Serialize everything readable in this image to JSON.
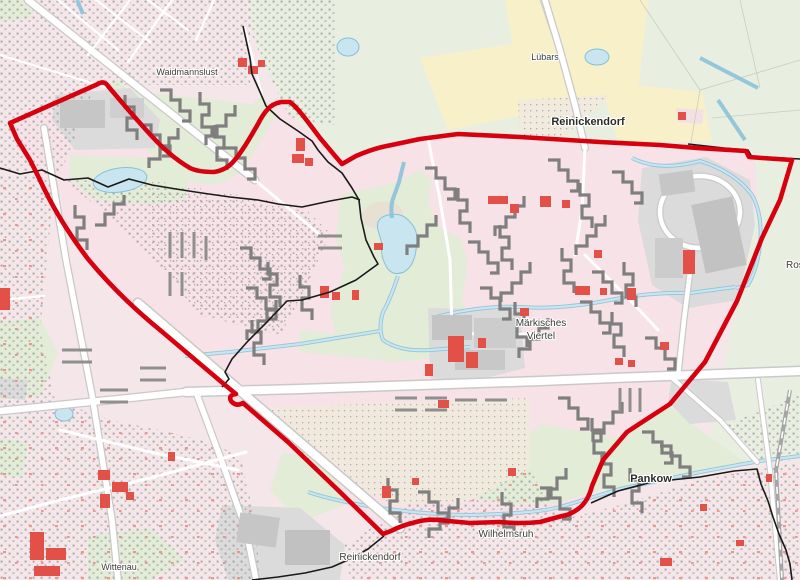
{
  "map": {
    "labels": [
      {
        "id": "luebars",
        "text": "Lübars",
        "x": 545,
        "y": 60,
        "size": 9,
        "bold": false
      },
      {
        "id": "reinickendorf-north",
        "text": "Reinickendorf",
        "x": 588,
        "y": 125,
        "size": 11,
        "bold": true
      },
      {
        "id": "waidmannslust",
        "text": "Waidmannslust",
        "x": 187,
        "y": 75,
        "size": 9,
        "bold": false
      },
      {
        "id": "maerkisches",
        "text": "Märkisches",
        "x": 541,
        "y": 326,
        "size": 10,
        "bold": false
      },
      {
        "id": "viertel",
        "text": "Viertel",
        "x": 541,
        "y": 339,
        "size": 10,
        "bold": false
      },
      {
        "id": "pankow",
        "text": "Pankow",
        "x": 651,
        "y": 482,
        "size": 11,
        "bold": true
      },
      {
        "id": "wilhelmsruh",
        "text": "Wilhelmsruh",
        "x": 506,
        "y": 537,
        "size": 10,
        "bold": false
      },
      {
        "id": "reinickendorf-south",
        "text": "Reinickendorf",
        "x": 370,
        "y": 560,
        "size": 10,
        "bold": false
      },
      {
        "id": "wittenau",
        "text": "Wittenau",
        "x": 119,
        "y": 570,
        "size": 9,
        "bold": false
      },
      {
        "id": "rosenthal",
        "text": "Rosenthal",
        "x": 786,
        "y": 268,
        "size": 10,
        "bold": false
      }
    ],
    "colors": {
      "boundary_red": "#d6000f",
      "district_boundary": "#1a1a1a",
      "base_pink": "#f5e7e9",
      "mv_pink": "#f7e2e7",
      "field_yellow": "#f8f0c9",
      "park_green": "#e2ecd6",
      "meadow_green": "#e9efe0",
      "water_fill": "#c9e5f0",
      "water_stroke": "#85c0d8",
      "industrial_gray": "#dbdbdb",
      "building_gray": "#7f7f7f",
      "public_red": "#e25048",
      "road_white": "#ffffff",
      "road_casing": "#c9c9c9"
    },
    "boundaries": {
      "red_outline": "project area boundary",
      "black_line": "district boundary"
    }
  }
}
